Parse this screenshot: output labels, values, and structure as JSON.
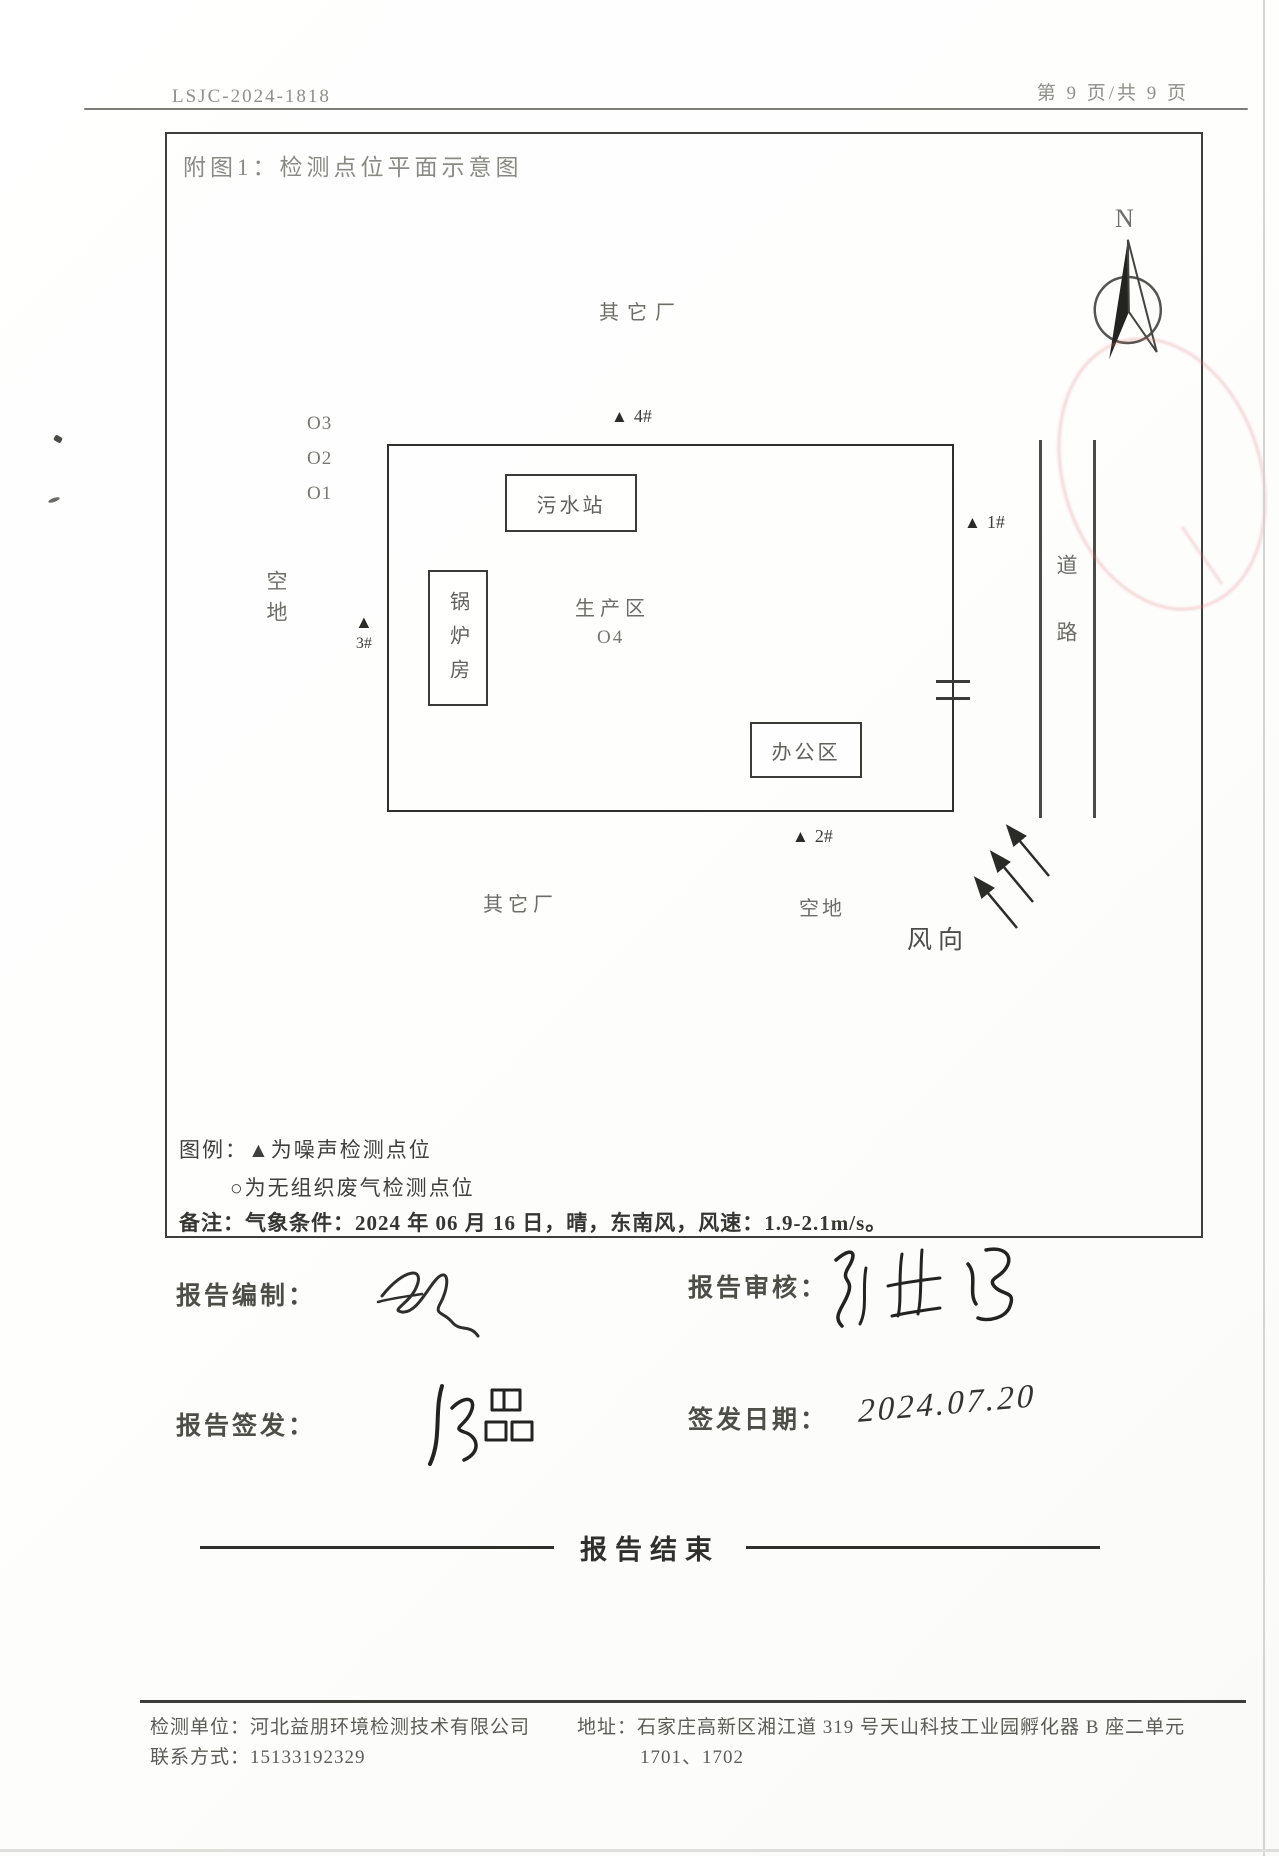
{
  "header": {
    "doc_number": "LSJC-2024-1818",
    "page_info": "第 9 页/共 9 页"
  },
  "figure": {
    "title": "附图1：检测点位平面示意图",
    "compass_label": "N",
    "zones": {
      "other_factory_top": "其它厂",
      "other_factory_bottom": "其它厂",
      "empty_lot_left": "空地",
      "empty_lot_bottom": "空地",
      "road": "道路",
      "production_area": "生产区",
      "sewage_station": "污水站",
      "boiler_room": "锅炉房",
      "office_area": "办公区",
      "wind_direction": "风向"
    },
    "markers": {
      "glyph": "▲",
      "p1": "1#",
      "p2": "2#",
      "p3": "3#",
      "p4": "4#",
      "o1": "O1",
      "o2": "O2",
      "o3": "O3",
      "o4": "O4"
    },
    "legend": {
      "label": "图例：",
      "noise_item": "▲为噪声检测点位",
      "gas_item": "○为无组织废气检测点位"
    },
    "note": {
      "label": "备注：",
      "text": "气象条件：2024 年 06 月 16 日，晴，东南风，风速：1.9-2.1m/s。"
    }
  },
  "signatures": {
    "prepared_label": "报告编制：",
    "reviewed_label": "报告审核：",
    "issued_label": "报告签发：",
    "issue_date_label": "签发日期：",
    "issue_date_value": "2024.07.20"
  },
  "report_end": "报告结束",
  "footer": {
    "org": "检测单位：河北益朋环境检测技术有限公司",
    "contact": "联系方式：15133192329",
    "address_line1": "地址：石家庄高新区湘江道 319 号天山科技工业园孵化器 B 座二单元",
    "address_line2": "1701、1702"
  },
  "colors": {
    "ink": "#3e3e3a",
    "faded_ink": "#8a8a85",
    "stamp_red": "#de7878"
  }
}
